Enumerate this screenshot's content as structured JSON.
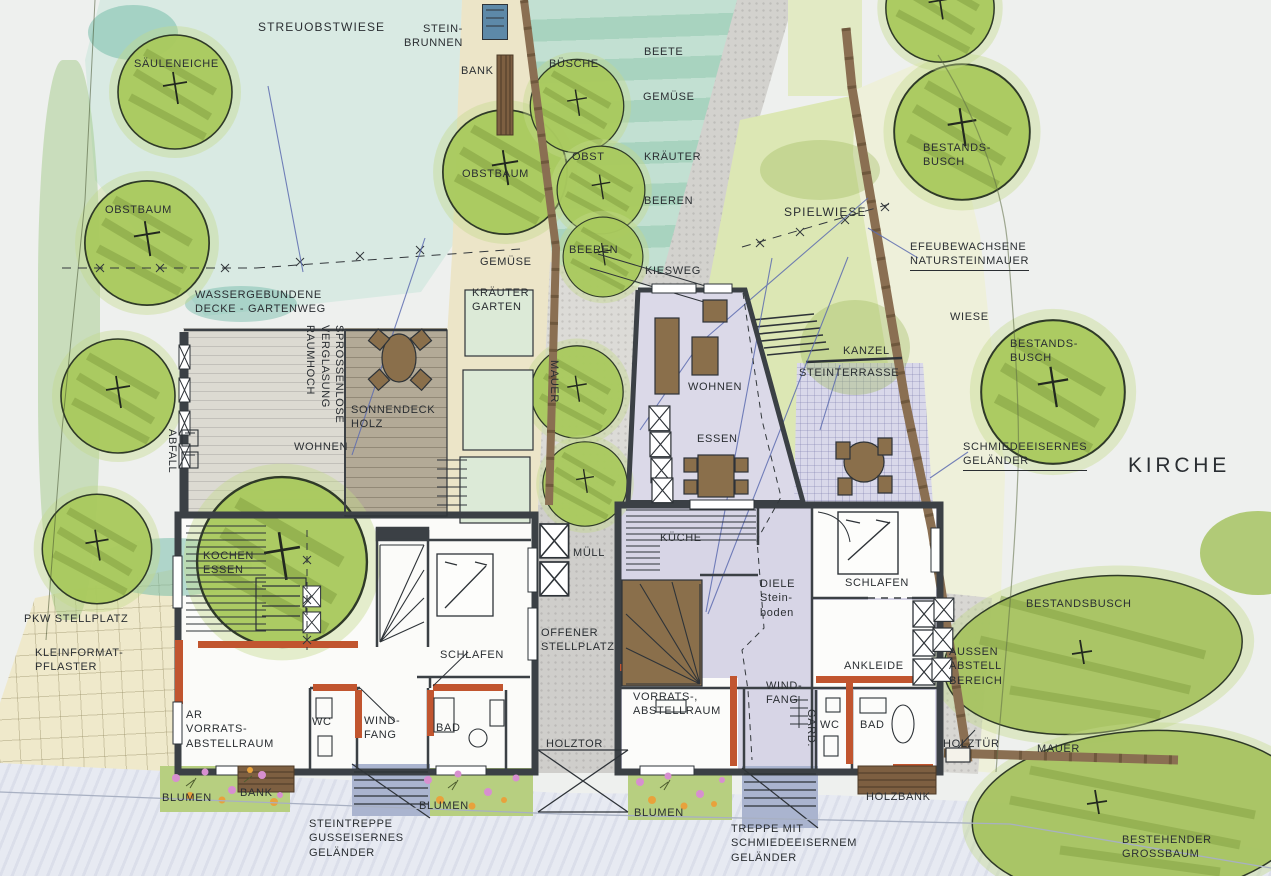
{
  "colors": {
    "wall_dark": "#3b4045",
    "accent_orange": "#c1552f",
    "lawn_aqua": "#d9eae3",
    "garden_teal": "#a8d3bf",
    "tree_green": "#a9c95d",
    "floor_lavender": "#d7d5e6",
    "deck_wood": "#b3aa97",
    "path_gray": "#d2d1cd",
    "street_blue": "#e7eaf2",
    "paving_cream": "#efe9cb",
    "stone_wall_brown": "#8a6f52",
    "flowerbed_green": "#b7cf80",
    "flower_pink": "#d78fd0",
    "flower_orange": "#e8a23c",
    "leader_blue": "#5d6cb0"
  },
  "labels": {
    "garden": {
      "streuobstwiese": "STREUOBSTWIESE",
      "saeuleneiche": "SÄULENEICHE",
      "steinbrunnen": "STEIN-\nBRUNNEN",
      "bank_top": "BANK",
      "buesche": "BÜSCHE",
      "beete": "BEETE",
      "gemuese_upper": "GEMÜSE",
      "obst": "OBST",
      "kraeuter": "KRÄUTER",
      "beeren_upper": "BEEREN",
      "obstbaum_left": "OBSTBAUM",
      "obstbaum_center": "OBSTBAUM",
      "beeren_lower": "BEEREN",
      "gemuese_lower": "GEMÜSE",
      "wassergebundene": "WASSERGEBUNDENE\nDECKE - GARTENWEG",
      "kraeutergarten": "KRÄUTER\nGARTEN",
      "mauer_garden": "MAUER",
      "abfall": "ABFALL",
      "kiesweg": "KIESWEG",
      "spielwiese": "SPIELWIESE"
    },
    "left_house": {
      "sprossenlose": "SPROSSENLOSE\nVERGLASUNG\nRAUMHOCH",
      "sonnendeck": "SONNENDECK\nHOLZ",
      "wohnen": "WOHNEN",
      "kochen_essen": "KOCHEN\nESSEN",
      "schlafen": "SCHLAFEN",
      "wc": "WC",
      "windfang": "WIND-\nFANG",
      "bad": "BAD",
      "abstellraum": "AR\nVORRATS-\nABSTELLRAUM",
      "muell": "MÜLL",
      "offener_stellplatz": "OFFENER\nSTELLPLATZ",
      "holztor": "HOLZTOR",
      "pkw_stellplatz": "PKW STELLPLATZ",
      "kleinformatpflaster": "KLEINFORMAT-\nPFLASTER",
      "blumen_west": "BLUMEN",
      "bank": "BANK",
      "blumen_ost": "BLUMEN",
      "steintreppe": "STEINTREPPE\nGUSSEISERNES\nGELÄNDER"
    },
    "right_house": {
      "wohnen": "WOHNEN",
      "essen": "ESSEN",
      "kueche": "KÜCHE",
      "diele": "DIELE\nStein-\nboden",
      "schlafen": "SCHLAFEN",
      "ankleide": "ANKLEIDE",
      "vorratsraum": "VORRATS-,\nABSTELLRAUM",
      "windfang": "WIND-\nFANG",
      "gard": "GARD.",
      "wc": "WC",
      "bad": "BAD",
      "kanzel": "KANZEL",
      "steinterrasse": "STEINTERRASSE",
      "blumen": "BLUMEN",
      "holzbank": "HOLZBANK",
      "treppe": "TREPPE MIT\nSCHMIEDEEISERNEM\nGELÄNDER",
      "aussen_abstell": "AUSSEN\nABSTELL\nBEREICH",
      "holztuer": "HOLZTÜR"
    },
    "surroundings": {
      "efeumauer": "EFEUBEWACHSENE\nNATURSTEINMAUER",
      "wiese": "WIESE",
      "bestandsbusch_nord": "BESTANDS-\nBUSCH",
      "bestandsbusch_mitte": "BESTANDS-\nBUSCH",
      "bestandsbusch_sued": "BESTANDSBUSCH",
      "schmiede": "SCHMIEDEEISERNES\nGELÄNDER",
      "kirche": "KIRCHE",
      "mauer": "MAUER",
      "grossbaum": "BESTEHENDER\nGROSSBAUM"
    }
  }
}
